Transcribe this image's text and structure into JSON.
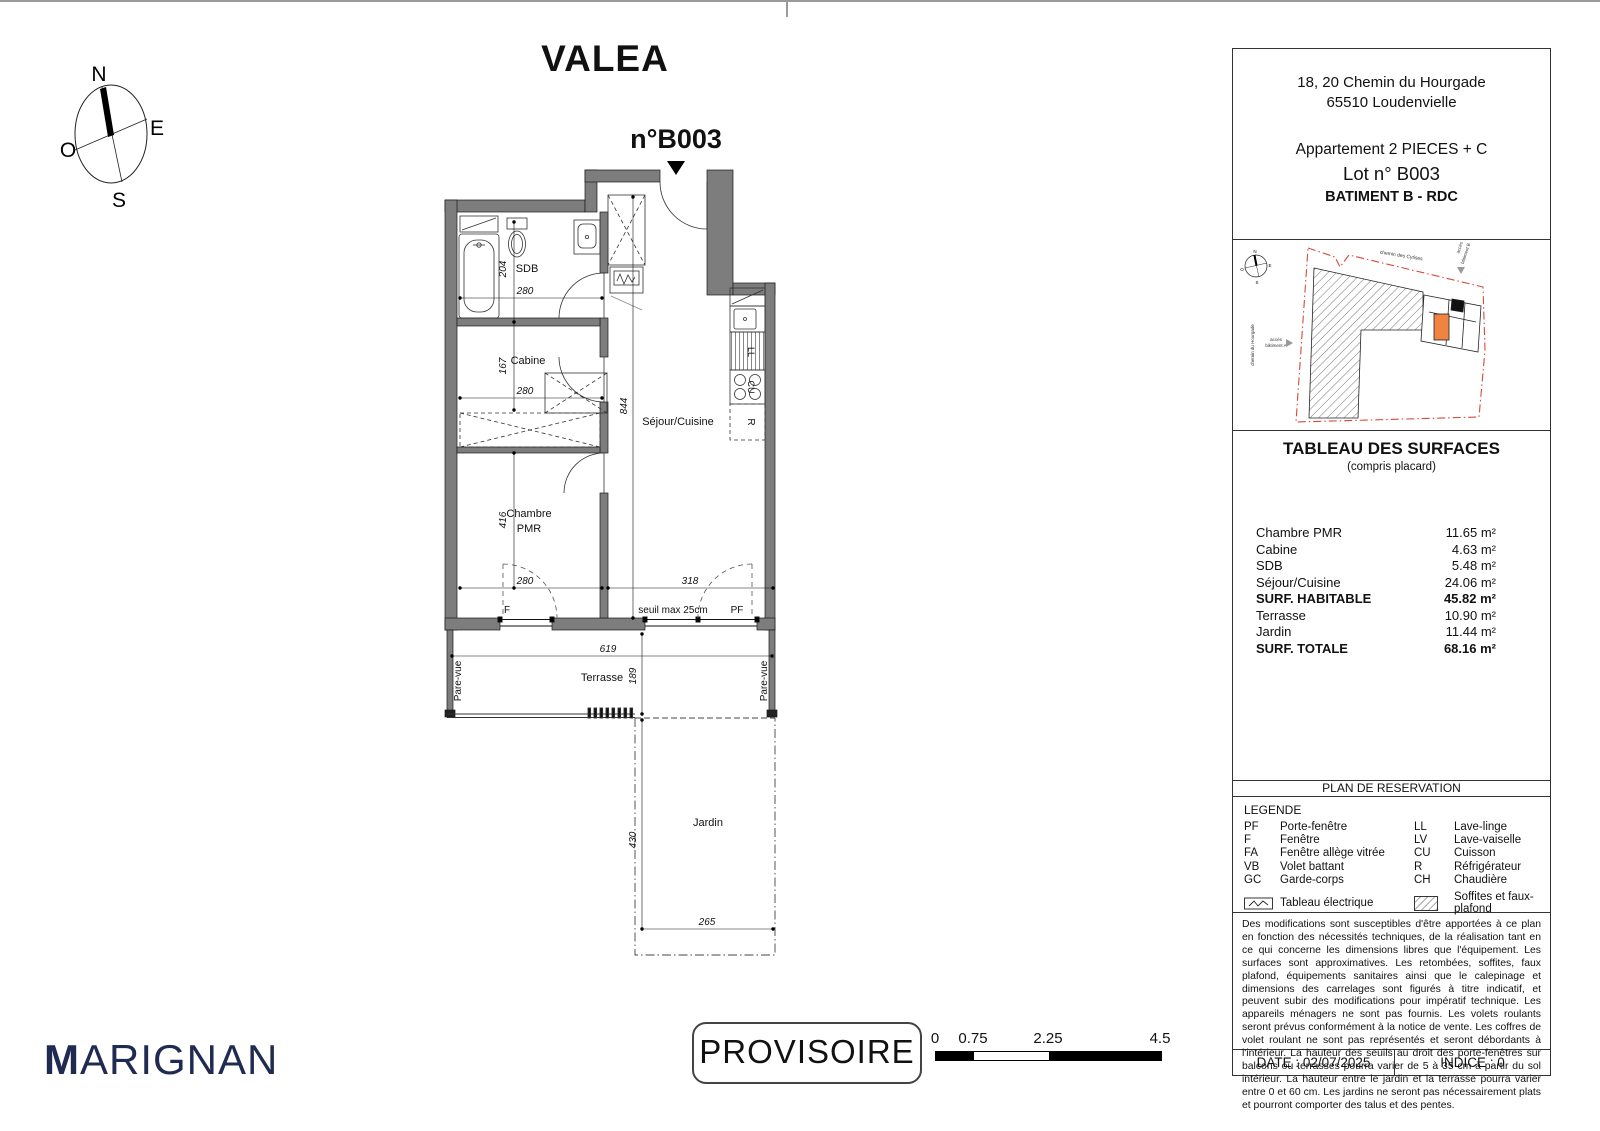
{
  "title": "VALEA",
  "unit_label": "n°B003",
  "compass": {
    "n": "N",
    "e": "E",
    "o": "O",
    "s": "S"
  },
  "plan": {
    "rooms": {
      "sdb": "SDB",
      "cabine": "Cabine",
      "chambre1": "Chambre",
      "chambre2": "PMR",
      "sejour": "Séjour/Cuisine",
      "terrasse": "Terrasse",
      "jardin": "Jardin"
    },
    "dims": {
      "h204": "204",
      "w280a": "280",
      "h167": "167",
      "w280b": "280",
      "v844": "844",
      "h416": "416",
      "w280c": "280",
      "w318": "318",
      "w619": "619",
      "h189": "189",
      "h430": "430",
      "w265": "265"
    },
    "ann": {
      "f": "F",
      "seuil": "seuil max 25cm",
      "pf": "PF",
      "pare_vue": "Pare-vue",
      "ll": "LL",
      "cu": "CU",
      "r": "R"
    }
  },
  "panel": {
    "address1": "18, 20 Chemin du Hourgade",
    "address2": "65510 Loudenvielle",
    "apt": "Appartement 2 PIECES + C",
    "lot": "Lot n° B003",
    "building": "BATIMENT B - RDC",
    "site": {
      "street_top": "chemin des Cytises",
      "street_left": "chemin du Hourgade",
      "access_a1": "accès",
      "access_a2": "bâtiment A",
      "access_b1": "accès",
      "access_b2": "bâtiment B",
      "n": "N",
      "e": "E",
      "o": "O",
      "s": "S"
    },
    "surfaces": {
      "title": "TABLEAU DES SURFACES",
      "subtitle": "(compris placard)",
      "rows": [
        {
          "label": "Chambre PMR",
          "value": "11.65 m²"
        },
        {
          "label": "Cabine",
          "value": "4.63 m²"
        },
        {
          "label": "SDB",
          "value": "5.48 m²"
        },
        {
          "label": "Séjour/Cuisine",
          "value": "24.06 m²"
        },
        {
          "label": "SURF. HABITABLE",
          "value": "45.82 m²"
        },
        {
          "label": "Terrasse",
          "value": "10.90 m²"
        },
        {
          "label": "Jardin",
          "value": "11.44 m²"
        },
        {
          "label": "SURF. TOTALE",
          "value": "68.16 m²"
        }
      ]
    },
    "reservation": "PLAN DE RESERVATION",
    "legend": {
      "title": "LEGENDE",
      "left": [
        {
          "abbr": "PF",
          "label": "Porte-fenêtre"
        },
        {
          "abbr": "F",
          "label": "Fenêtre"
        },
        {
          "abbr": "FA",
          "label": "Fenêtre allège vitrée"
        },
        {
          "abbr": "VB",
          "label": "Volet battant"
        },
        {
          "abbr": "GC",
          "label": "Garde-corps"
        }
      ],
      "right": [
        {
          "abbr": "LL",
          "label": "Lave-linge"
        },
        {
          "abbr": "LV",
          "label": "Lave-vaiselle"
        },
        {
          "abbr": "CU",
          "label": "Cuisson"
        },
        {
          "abbr": "R",
          "label": "Réfrigérateur"
        },
        {
          "abbr": "CH",
          "label": "Chaudière"
        }
      ],
      "elec": "Tableau électrique",
      "soffites": "Soffites et faux-plafond"
    },
    "disclaimer": "Des modifications sont susceptibles d'être apportées à ce plan en fonction des nécessités techniques, de la réalisation tant en ce qui concerne les dimensions libres que l'équipement. Les surfaces sont approximatives. Les retombées, soffites, faux plafond, équipements sanitaires ainsi que le calepinage et dimensions des carrelages sont figurés à titre indicatif, et peuvent subir des modifications pour impératif technique. Les appareils ménagers ne sont pas fournis. Les volets roulants seront prévus conformément à la notice de vente. Les coffres de volet roulant ne sont pas représentés et seront débordants à l'intérieur. La hauteur des seuils au droit des porte-fenêtres sur balcons ou terrasses pourra varier de 5 à 35 cm à partir du sol intérieur. La hauteur entre le jardin et la terrasse pourra varier entre 0 et 60 cm. Les jardins ne seront pas nécessairement plats et pourront comporter des talus et des pentes.",
    "date": "DATE : 02/07/2025",
    "indice": "INDICE : 0"
  },
  "footer": {
    "brand_m": "M",
    "brand_rest": "ARIGNAN",
    "status": "PROVISOIRE",
    "scale": [
      "0",
      "0.75",
      "2.25",
      "4.5"
    ]
  },
  "colors": {
    "wall": "#7d7d7d",
    "brand_navy": "#1f2b50",
    "boundary_red": "#d6493f",
    "unit_orange": "#ef8440"
  }
}
